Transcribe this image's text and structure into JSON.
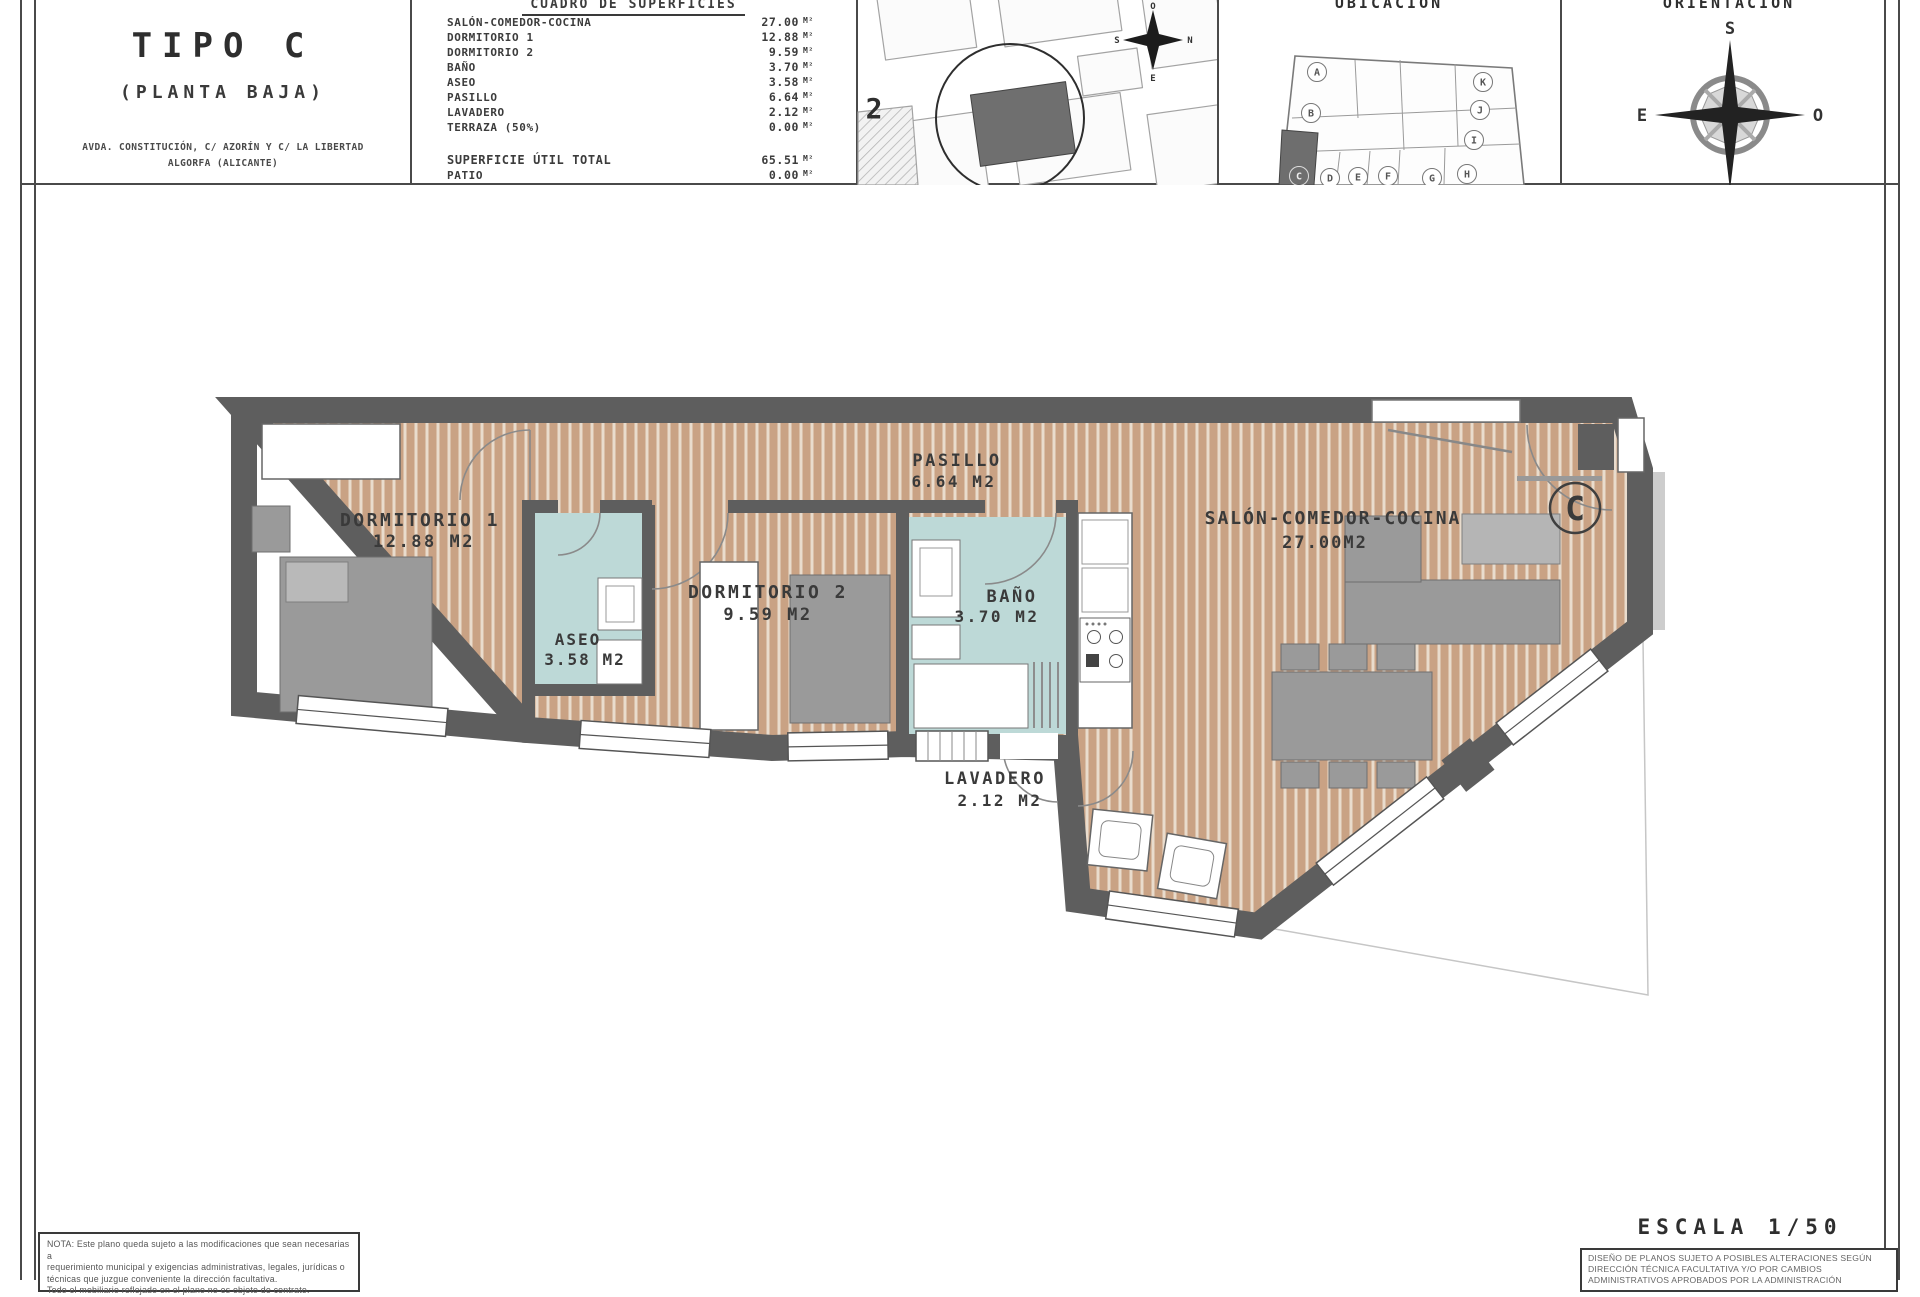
{
  "title_block": {
    "type_label": "TIPO C",
    "floor_label": "(PLANTA BAJA)",
    "address_line1": "AVDA. CONSTITUCIÓN, C/ AZORÍN Y C/ LA LIBERTAD",
    "address_line2": "ALGORFA (ALICANTE)"
  },
  "surface_table": {
    "header": "CUADRO DE SUPERFICIES",
    "unit": "M²",
    "rows": [
      {
        "label": "SALÓN-COMEDOR-COCINA",
        "value": "27.00"
      },
      {
        "label": "DORMITORIO 1",
        "value": "12.88"
      },
      {
        "label": "DORMITORIO 2",
        "value": "9.59"
      },
      {
        "label": "BAÑO",
        "value": "3.70"
      },
      {
        "label": "ASEO",
        "value": "3.58"
      },
      {
        "label": "PASILLO",
        "value": "6.64"
      },
      {
        "label": "LAVADERO",
        "value": "2.12"
      },
      {
        "label": "TERRAZA (50%)",
        "value": "0.00"
      }
    ],
    "totals": [
      {
        "label": "SUPERFICIE ÚTIL TOTAL",
        "value": "65.51"
      },
      {
        "label": "PATIO",
        "value": "0.00"
      },
      {
        "label": "TERRAZA (100%)",
        "value": "0.00"
      }
    ]
  },
  "site_map": {
    "plot_label": "2",
    "compass": {
      "top": "O",
      "left": "S",
      "right": "N",
      "bottom": "E"
    }
  },
  "ubicacion": {
    "title": "UBICACIÓN",
    "highlighted_unit": "C",
    "units": [
      "A",
      "B",
      "C",
      "D",
      "E",
      "F",
      "G",
      "H",
      "I",
      "J",
      "K"
    ]
  },
  "orientacion": {
    "title": "ORIENTACIÓN",
    "compass": {
      "top": "S",
      "bottom": "N",
      "left": "E",
      "right": "O"
    }
  },
  "floor_plan": {
    "unit_mark": "C",
    "rooms": [
      {
        "name": "DORMITORIO 1",
        "area": "12.88 M2"
      },
      {
        "name": "ASEO",
        "area": "3.58 M2"
      },
      {
        "name": "DORMITORIO 2",
        "area": "9.59 M2"
      },
      {
        "name": "PASILLO",
        "area": "6.64 M2"
      },
      {
        "name": "BAÑO",
        "area": "3.70 M2"
      },
      {
        "name": "LAVADERO",
        "area": "2.12 M2"
      },
      {
        "name": "SALÓN-COMEDOR-COCINA",
        "area": "27.00M2"
      }
    ]
  },
  "footer": {
    "escala": "ESCALA 1/50",
    "nota_line1": "NOTA: Este plano queda sujeto a las modificaciones que sean necesarias a",
    "nota_line2": "requerimiento municipal y exigencias administrativas, legales, jurídicas o",
    "nota_line3": "técnicas que juzgue conveniente la dirección facultativa.",
    "nota_line4": "Todo el mobiliario reflejado en el plano no es objeto de contrato.",
    "disclaimer_line1": "DISEÑO DE PLANOS SUJETO A POSIBLES ALTERACIONES SEGÚN",
    "disclaimer_line2": "DIRECCIÓN TÉCNICA FACULTATIVA Y/O POR CAMBIOS",
    "disclaimer_line3": "ADMINISTRATIVOS APROBADOS POR LA ADMINISTRACIÓN"
  },
  "colors": {
    "wall": "#5e5e5e",
    "wood": "#c9a284",
    "wood_stripe": "#e9dccd",
    "wet_room": "#bdd9d7",
    "furniture": "#9a9a9a",
    "text": "#3c3c3c"
  }
}
